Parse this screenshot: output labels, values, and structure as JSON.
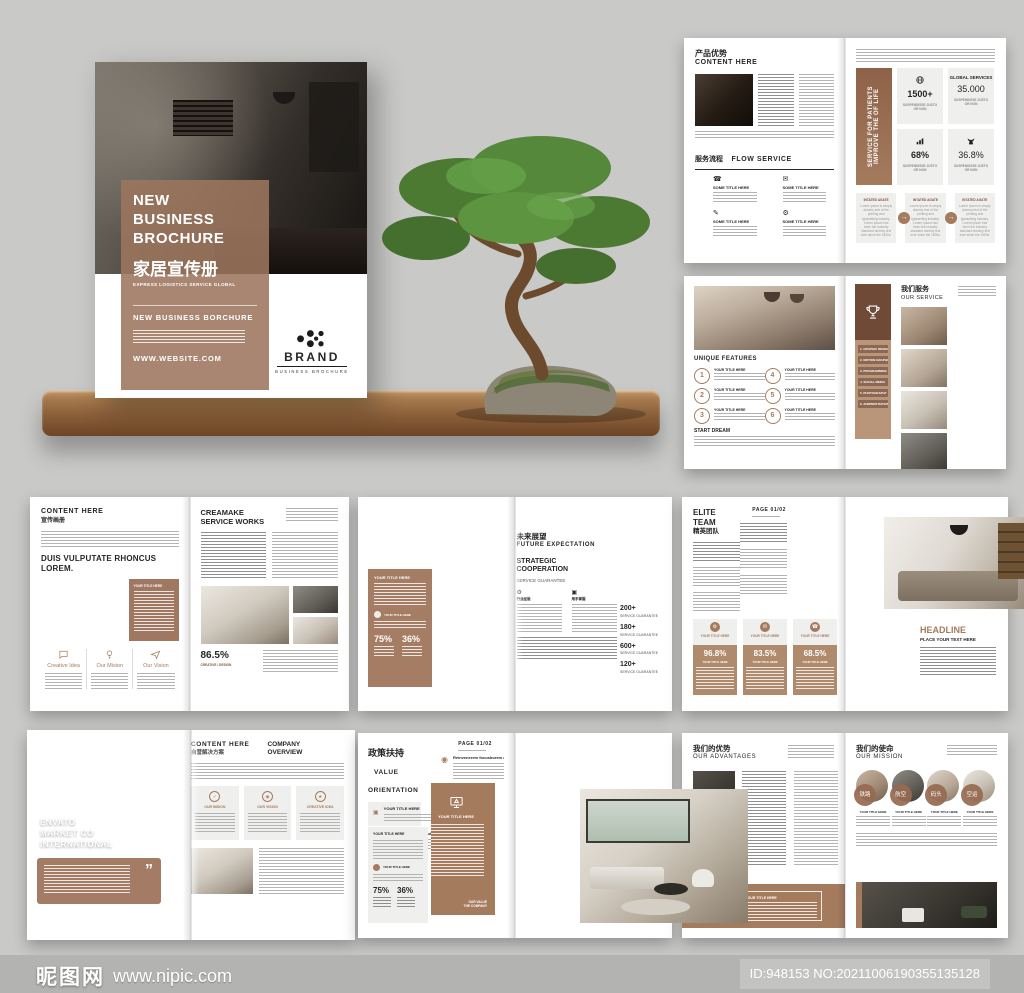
{
  "watermark": {
    "site": "昵图网",
    "url": "www.nipic.com",
    "id": "ID:948153 NO:20211006190355135128"
  },
  "icons": {
    "gear": "⚙",
    "mail": "✉",
    "phone": "☎",
    "globe": "⊕",
    "arrow": "→",
    "quote": "”",
    "check": "✓",
    "pen": "✎",
    "person": "◉",
    "grid": "▣",
    "star": "★"
  },
  "cover": {
    "t1": "NEW",
    "t2": "BUSINESS",
    "t3": "BROCHURE",
    "cn": "家居宣传册",
    "tagline": "EXPRESS LOGISTICS SERVICE GLOBAL",
    "sub": "NEW BUSINESS BORCHURE",
    "site": "WWW.WEBSITE.COM",
    "brand": "BRAND",
    "brand_sub": "BUSINESS BROCHURE"
  },
  "adv": {
    "cn": "产品优势",
    "en": "CONTENT HERE",
    "flow_cn": "服务流程",
    "flow_en": "FLOW SERVICE",
    "flow_title": "SOME TITLE HERE",
    "banner": "SERVICE FOR PATIENTS IMPROVE THE OF LIFE",
    "stat1": "1500+",
    "stat2_pre": "GLOBAL SERVICES",
    "stat2": "35.000",
    "stat3": "68%",
    "stat4": "36.8%",
    "stat_cap": "SUSPENDISSE JUSTO OR NON",
    "card_title": "INTATED AGATE",
    "card_body": "Lorem Ipsum is simply dummy text of the printing and typesetting industry. Lorem Ipsum has been the industry standard dummy text ever since the 1500s."
  },
  "svc": {
    "features": "UNIQUE FEATURES",
    "item_title": "YOUR TITLE HERE",
    "start": "START DREAM",
    "cn": "我们服务",
    "en": "OUR SERVICE",
    "block_title": "YOUR TITLE HERE",
    "menu": [
      "1. GRAPHIC DESIGN",
      "2. MOTION GRAPHIC",
      "3. PROGRAMMING",
      "4. SOCIAL MEDIA",
      "5. PHOTOGRAPHY",
      "6. ADMINISTRATION"
    ],
    "nums": [
      "1",
      "2",
      "3",
      "4",
      "5",
      "6"
    ]
  },
  "cre": {
    "en": "CONTENT HERE",
    "cn": "宣传画册",
    "headline": "DUIS VULPUTATE RHONCUS LOREM.",
    "col1": "Creative Idea",
    "col2": "Our Mision",
    "col3": "Our Vision",
    "r1": "CREAMAKE",
    "r2": "SERVICE WORKS",
    "stat": "86.5%",
    "stat_label": "CREATIVE / DESIGN"
  },
  "fut": {
    "panel_title": "YOUR TITLE HERE",
    "item_title": "YOUR TITLE HERE",
    "s75": "75%",
    "s36": "36%",
    "cn": "未来展望",
    "en": "FUTURE EXPECTATION",
    "h1": "STRATEGIC",
    "h2": "COOPERATION",
    "sub": "SERVICE GUARANTEE",
    "col1": "行业经验",
    "col2": "用手掌握",
    "stats": [
      "200+",
      "180+",
      "600+",
      "120+"
    ],
    "stat_label": "SERVICE GUARANTEE"
  },
  "eli": {
    "en": "ELITE TEAM",
    "cn": "精英团队",
    "page": "PAGE 01/02",
    "card_title": "YOUR TITLE HERE",
    "v1": "96.8%",
    "v2": "83.5%",
    "v3": "68.5%",
    "headline": "HEADLINE",
    "sub": "PLACE YOUR TEXT HERE"
  },
  "com": {
    "l1": "ENVATO",
    "l2": "MARKET CO",
    "l3": "INTERNATIONAL",
    "en": "CONTENT HERE",
    "cn": "自营解决方案",
    "o1": "COMPANY",
    "o2": "OVERVIEW",
    "c1": "OUR MISION",
    "c2": "OUR VISION",
    "c3": "CREATIVE IDEA"
  },
  "val": {
    "cn": "政策扶持",
    "en": "VALUE ORIENTATION",
    "page": "PAGE 01/02",
    "bar_title": "YOUR TITLE HERE",
    "lead": "Reinvenerem focusborem aut aut",
    "panel_title": "YOUR TITLE HERE",
    "item_title": "YOUR TITLE HERE",
    "s75": "75%",
    "s36": "36%",
    "right_panel_title": "YOUR TITLE HERE",
    "f1": "OUR VALUE",
    "f2": "THE COMPANY"
  },
  "mis": {
    "adv_cn": "我们的优势",
    "adv_en": "OUR ADVANTAGES",
    "photo_cap": "YOUR TITLE HERE",
    "band_title": "YOUR TITLE HERE",
    "cn": "我们的使命",
    "en": "OUR MISSION",
    "item_title": "YOUR TITLE HERE",
    "circ": [
      "铁路",
      "航空",
      "码头",
      "空运"
    ]
  }
}
